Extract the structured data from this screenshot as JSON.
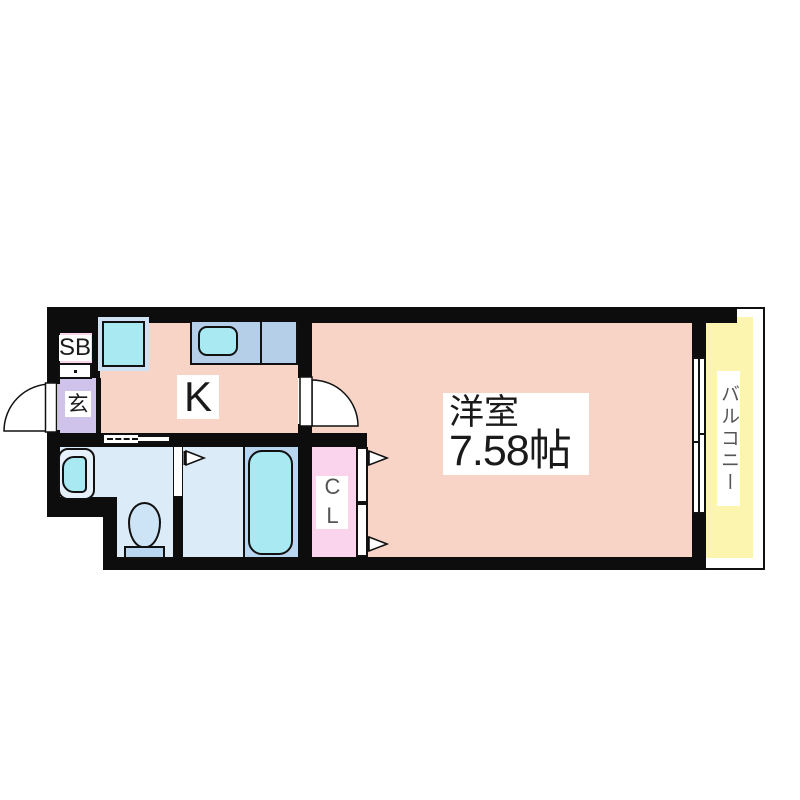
{
  "plan_type": "apartment-floor-plan",
  "rooms": {
    "western": {
      "name": "洋室",
      "size": "7.58帖"
    },
    "kitchen": {
      "label": "K"
    },
    "entrance": {
      "label": "玄"
    },
    "shoebox": {
      "label": "SB"
    },
    "closet": {
      "label": "CL"
    },
    "balcony": {
      "label": "バルコニー"
    }
  },
  "colors": {
    "wall": "#0d0d0d",
    "room_pink": "#f8d4c6",
    "entrance_purple": "#cfc2eb",
    "accent_pink": "#f9d4ec",
    "water_light_blue": "#dcebf8",
    "water_medium_blue": "#b9d6f0",
    "fixture_cyan": "#a9e9f2",
    "counter_blue": "#b5cfe9",
    "balcony_yellow": "#fbf5af"
  }
}
